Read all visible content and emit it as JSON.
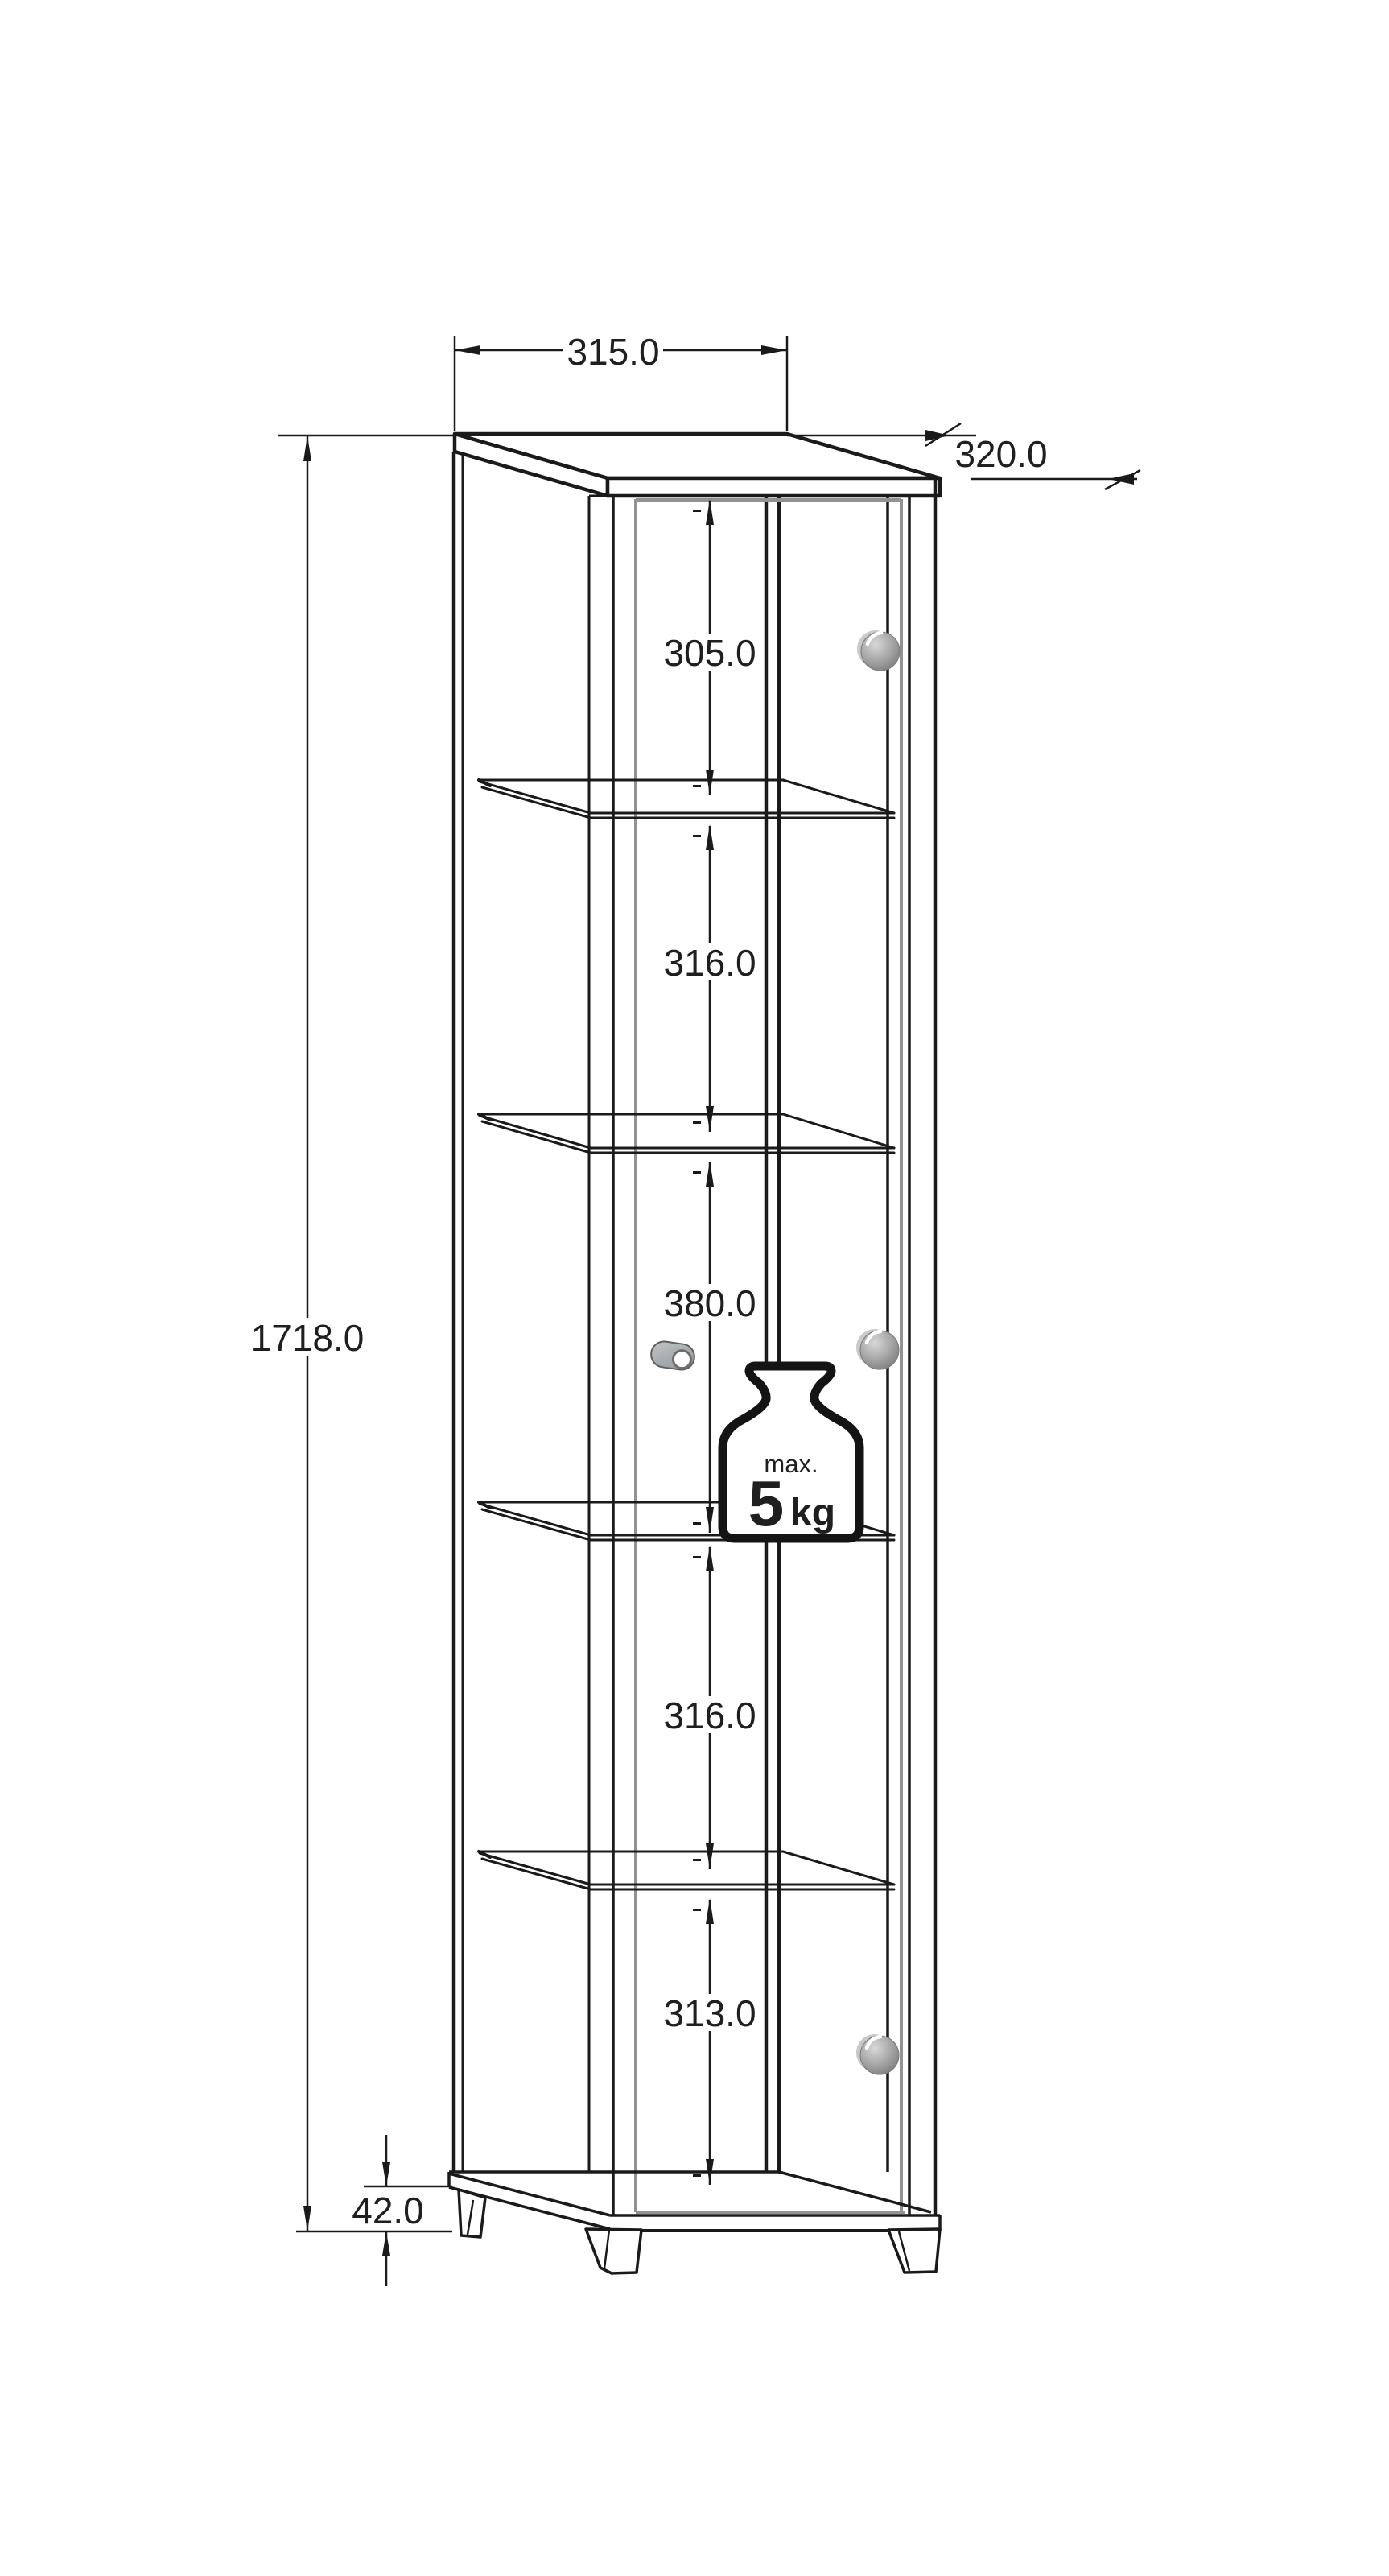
{
  "drawing": {
    "product": "Tall display cabinet with glass door and four glass shelves - dimensional drawing",
    "dims": {
      "top_width": "315.0",
      "depth": "320.0",
      "total_height": "1718.0",
      "plinth_height": "42.0",
      "shelf_gaps": [
        "305.0",
        "316.0",
        "380.0",
        "316.0",
        "313.0"
      ]
    },
    "max_load": {
      "label": "max.",
      "value": "5",
      "unit": "kg"
    },
    "colors": {
      "line": "#1a1a1a",
      "glass_edge": "#929292",
      "knob_fill": "#a9a9a9",
      "background": "#ffffff"
    },
    "icons": [
      {
        "name": "door-knob",
        "count": 3
      },
      {
        "name": "magnetic-catch",
        "count": 1
      },
      {
        "name": "max-load-weight",
        "count": 1
      }
    ]
  }
}
